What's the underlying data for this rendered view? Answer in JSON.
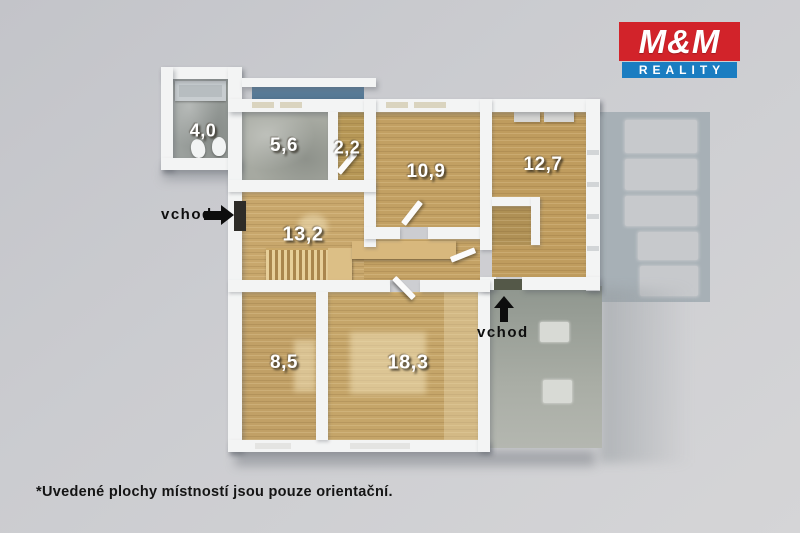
{
  "logo": {
    "top_text": "M&M",
    "bottom_text": "REALITY",
    "red": "#d2232a",
    "blue": "#1a7dc1"
  },
  "plan": {
    "rooms": [
      {
        "name": "bathroom-annex",
        "area": "4,0",
        "floor": "tile"
      },
      {
        "name": "bathroom",
        "area": "5,6",
        "floor": "tile"
      },
      {
        "name": "wc",
        "area": "2,2",
        "floor": "wood"
      },
      {
        "name": "bedroom-top",
        "area": "10,9",
        "floor": "wood"
      },
      {
        "name": "bedroom-right",
        "area": "12,7",
        "floor": "wood"
      },
      {
        "name": "hallway-stairs",
        "area": "13,2",
        "floor": "wood"
      },
      {
        "name": "room-bottom-left",
        "area": "8,5",
        "floor": "wood"
      },
      {
        "name": "living-room",
        "area": "18,3",
        "floor": "wood"
      }
    ],
    "entrance_side_label": "vchod",
    "entrance_bottom_label": "vchod"
  },
  "footnote": "*Uvedené plochy místností jsou pouze orientační."
}
